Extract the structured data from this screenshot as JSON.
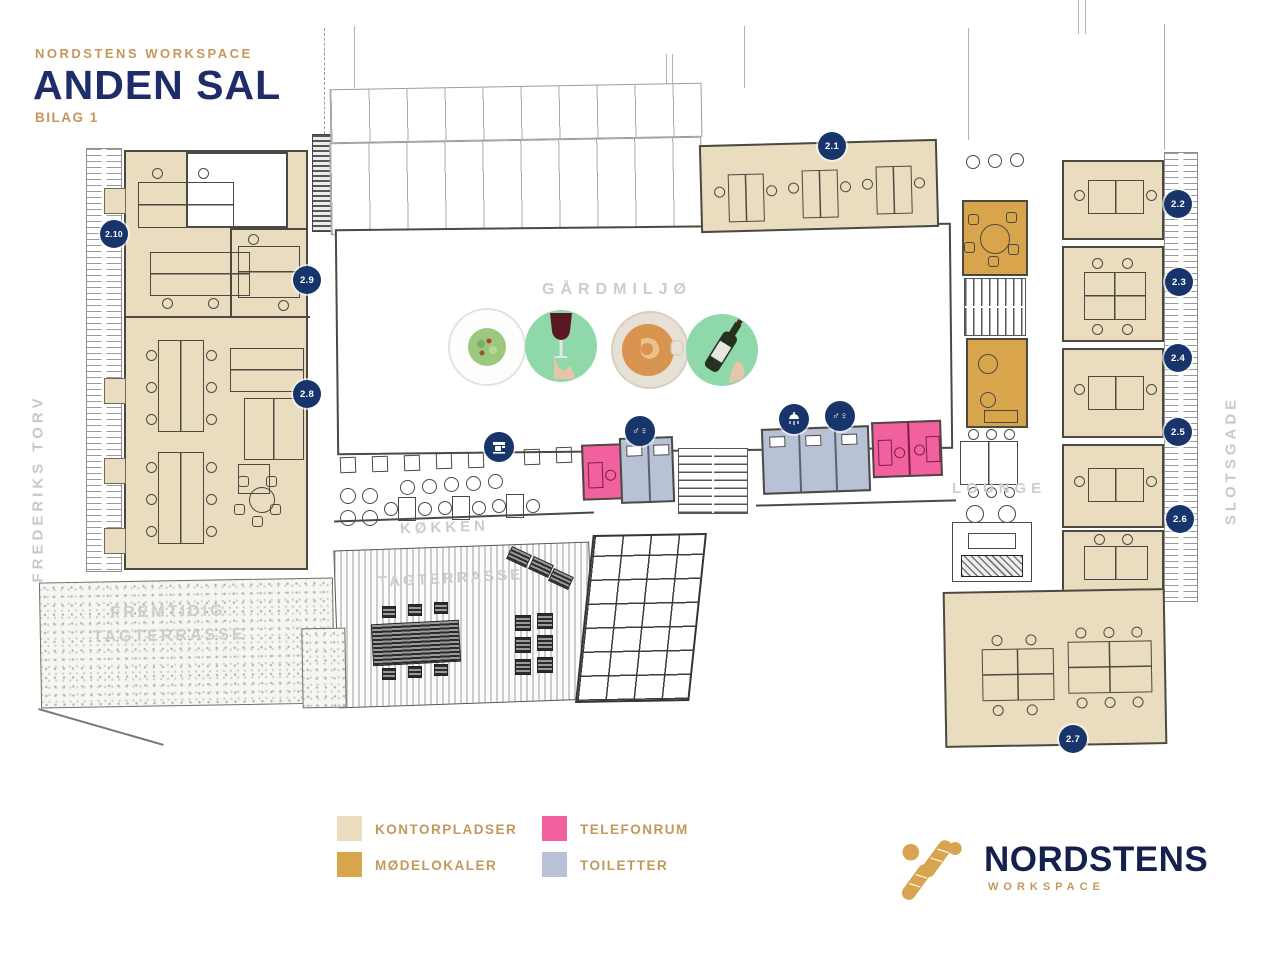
{
  "header": {
    "brand": "NORDSTENS WORKSPACE",
    "title": "ANDEN SAL",
    "subtitle": "BILAG 1"
  },
  "streets": {
    "left": "FREDERIKS TORV",
    "right": "SLOTSGADE"
  },
  "area_labels": {
    "courtyard": "GÅRDMILJØ",
    "kitchen": "KØKKEN",
    "lounge": "LOUNGE",
    "terrace": "TAGTERRASSE",
    "future_terrace_1": "FREMTIDIG",
    "future_terrace_2": "TAGTERRASSE"
  },
  "badges": [
    {
      "label": "2.1"
    },
    {
      "label": "2.2"
    },
    {
      "label": "2.3"
    },
    {
      "label": "2.4"
    },
    {
      "label": "2.5"
    },
    {
      "label": "2.6"
    },
    {
      "label": "2.7"
    },
    {
      "label": "2.8"
    },
    {
      "label": "2.9"
    },
    {
      "label": "2.10"
    }
  ],
  "amenity_icons": [
    {
      "name": "coffee-machine-icon"
    },
    {
      "name": "toilet-icon",
      "glyph": "♂♀"
    },
    {
      "name": "shower-icon"
    },
    {
      "name": "toilet-icon",
      "glyph": "♂♀"
    }
  ],
  "courtyard_photos": [
    {
      "name": "salad-photo"
    },
    {
      "name": "wine-glass-photo"
    },
    {
      "name": "coffee-photo"
    },
    {
      "name": "wine-bottle-photo"
    }
  ],
  "legend": {
    "items": [
      {
        "label": "KONTORPLADSER",
        "color": "#EADCBF"
      },
      {
        "label": "MØDELOKALER",
        "color": "#D8A44C"
      },
      {
        "label": "TELEFONRUM",
        "color": "#F2609E"
      },
      {
        "label": "TOILETTER",
        "color": "#B9C1D7"
      }
    ]
  },
  "logo": {
    "name": "NORDSTENS",
    "tagline": "WORKSPACE"
  },
  "colors": {
    "navy": "#1E2C6A",
    "badge_navy": "#17356B",
    "gold_text": "#C2995B",
    "label_gray": "#CCCCCC",
    "office": "#EADCBF",
    "meeting": "#D8A44C",
    "phone": "#F2609E",
    "toilet": "#B9C1D7",
    "photo_green": "#8FD8A9"
  }
}
